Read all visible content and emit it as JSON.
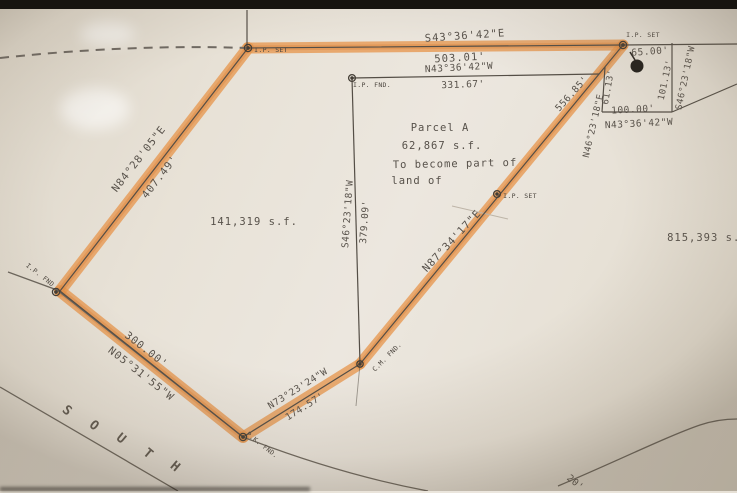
{
  "edges": {
    "top": {
      "bearing": "S43°36'42\"E",
      "distance": "503.01'"
    },
    "inner": {
      "bearing": "N43°36'42\"W",
      "distance": "331.67'"
    },
    "west": {
      "bearing": "N84°28'05\"E",
      "distance": "407.49'"
    },
    "southwest": {
      "bearing": "N05°31'55\"W",
      "distance": "300.00'"
    },
    "south": {
      "bearing": "N73°23'24\"W",
      "distance": "174.57'"
    },
    "diagonal": {
      "distance": "556.85'",
      "bearing": "N46°23'18\"E",
      "bearing2": "N87°34'17\"E"
    },
    "center": {
      "bearing": "S46°23'18\"W",
      "distance": "379.09'"
    },
    "northeast": {
      "seg65": "65.00'",
      "seg100": "100.00'",
      "seg100_bearing": "N43°36'42\"W",
      "seg61": "61.13'",
      "seg101": "101.13'",
      "seg101_bearing": "S46°23'18\"W"
    },
    "corner_partial": "20'"
  },
  "parcel": {
    "title": "Parcel A",
    "area": "62,867 s.f.",
    "note1": "To become part of",
    "note2": "land of"
  },
  "areas": {
    "west": "141,319 s.f.",
    "east": "815,393 s.f."
  },
  "monuments": {
    "nw": "I.P. SET",
    "ne": "I.P. SET",
    "inner": "I.P. FND.",
    "west": "I.P. FND",
    "south": "P.K. FND.",
    "mid": "C.M. FND.",
    "diag": "I.P. SET"
  },
  "road": {
    "letters": [
      "S",
      "O",
      "U",
      "T",
      "H"
    ]
  },
  "colors": {
    "highlight": "#e79750",
    "ink": "#57514a",
    "paper": "#e8e2d7"
  }
}
